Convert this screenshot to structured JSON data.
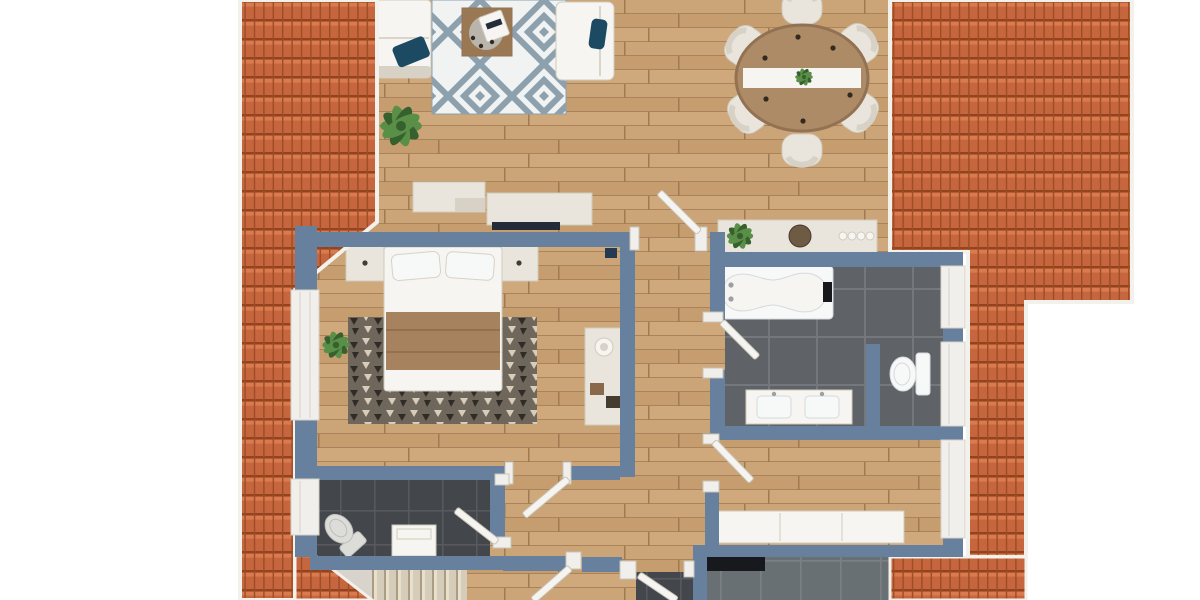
{
  "meta": {
    "description": "Top-down 3D rendered apartment floor plan with terracotta tiled roof sections on the left and right sides",
    "view": "orthographic top view",
    "floor_level": "attic storey"
  },
  "palette": {
    "bg": "#ffffff",
    "wall": "#66809e",
    "roofBase": "#c6663e",
    "roofDark": "#93441f",
    "roofLight": "#da7b4f",
    "roofLine": "#9c4c26",
    "gutter": "#f3f1ec",
    "woodA": "#cba477",
    "woodB": "#c59d6f",
    "woodC": "#cfa87c",
    "woodLine": "#ab835a",
    "woodJoint": "#a07a52",
    "bathTile": "#5f6266",
    "bathGrout": "#74787d",
    "wcTile": "#43474b",
    "wcGrout": "#565a5f",
    "kitTile": "#697074",
    "kitGrout": "#7c8084",
    "cream": "#e9e5dc",
    "creamStroke": "#d0cabc",
    "shade": "#d8d2c6",
    "white": "#f6f5f1",
    "fixtureWhite": "#f7f8f8",
    "fixtureStroke": "#d6dadd",
    "fixtureGray": "#dcdcd9",
    "fixtureGrayStroke": "#bdbdba",
    "grayFix": "#9aa0a5",
    "navy": "#1c4a63",
    "navySquare": "#233a52",
    "tvBlack": "#232c38",
    "rugBg": "#f1f2f2",
    "rugBlue": "#8ca1ad",
    "rugDarkBg": "#6f665c",
    "rugDarkA": "#d8cdbb",
    "rugDarkB": "#2f2b26",
    "throwBrown": "#a6825f",
    "throwBrownDark": "#94704f",
    "tableWood": "#ad8b67",
    "tableRim": "#937253",
    "coffeeWood": "#9b7854",
    "coffeeInner": "#b9b4ac",
    "green": "#5a8f48",
    "greenDark": "#36602e",
    "stairTread": "#d6ccba",
    "stairLine": "#ac9c82",
    "stairHi": "#e8dfcd",
    "landing": "#d8d4cb",
    "counterBlack": "#17191c",
    "doorLeaf": "#f6f4f0",
    "doorStroke": "#c9c4b8",
    "frameWhite": "#f0efec",
    "decorBowl": "#6d5b43",
    "decorBoxA": "#8a684a",
    "decorBoxB": "#453b2e",
    "dotDark": "#33291d",
    "headboard": "#ddd7cb"
  },
  "structure": {
    "roofs": [
      {
        "id": "roof-left",
        "material": "clay-tiles"
      },
      {
        "id": "roof-right",
        "material": "clay-tiles"
      }
    ],
    "windows": {
      "left_wall": 2,
      "right_wall": 3
    },
    "swing_doors": 7
  },
  "rooms": [
    {
      "name": "living-room",
      "floor": "wood",
      "furniture": [
        "corner-sofa",
        "navy-pillow",
        "armchair",
        "geometric-diamond-rug",
        "coffee-table",
        "serving-tray",
        "potted-plant",
        "tv-sideboard",
        "tv"
      ]
    },
    {
      "name": "dining-area",
      "floor": "wood",
      "furniture": [
        "oval-dining-table",
        "table-runner",
        "centerpiece-plant",
        "dining-chair-x6",
        "place-setting-dots"
      ]
    },
    {
      "name": "bedroom",
      "floor": "wood",
      "furniture": [
        "double-bed",
        "pillow-x2",
        "brown-bed-runner",
        "nightstand-x2",
        "patterned-dark-rug",
        "dresser",
        "decor-plate",
        "decor-boxes",
        "potted-plant",
        "wall-device-navy"
      ]
    },
    {
      "name": "bathroom",
      "floor": "dark-tile",
      "furniture": [
        "bathtub",
        "faucet",
        "toilet",
        "double-sink-vanity",
        "privacy-partition",
        "sideboard-console",
        "console-plant",
        "console-decor"
      ]
    },
    {
      "name": "wc",
      "floor": "dark-tile",
      "furniture": [
        "toilet-angled",
        "washbasin-cabinet"
      ]
    },
    {
      "name": "dressing-room",
      "floor": "wood",
      "furniture": [
        "long-wardrobe"
      ]
    },
    {
      "name": "kitchen-below",
      "floor": "gray-tile",
      "furniture": [
        "black-countertop"
      ]
    },
    {
      "name": "hallway",
      "floor": "wood",
      "furniture": []
    },
    {
      "name": "staircase",
      "floor": "stairs",
      "furniture": [
        "stair-treads",
        "landing"
      ]
    }
  ]
}
